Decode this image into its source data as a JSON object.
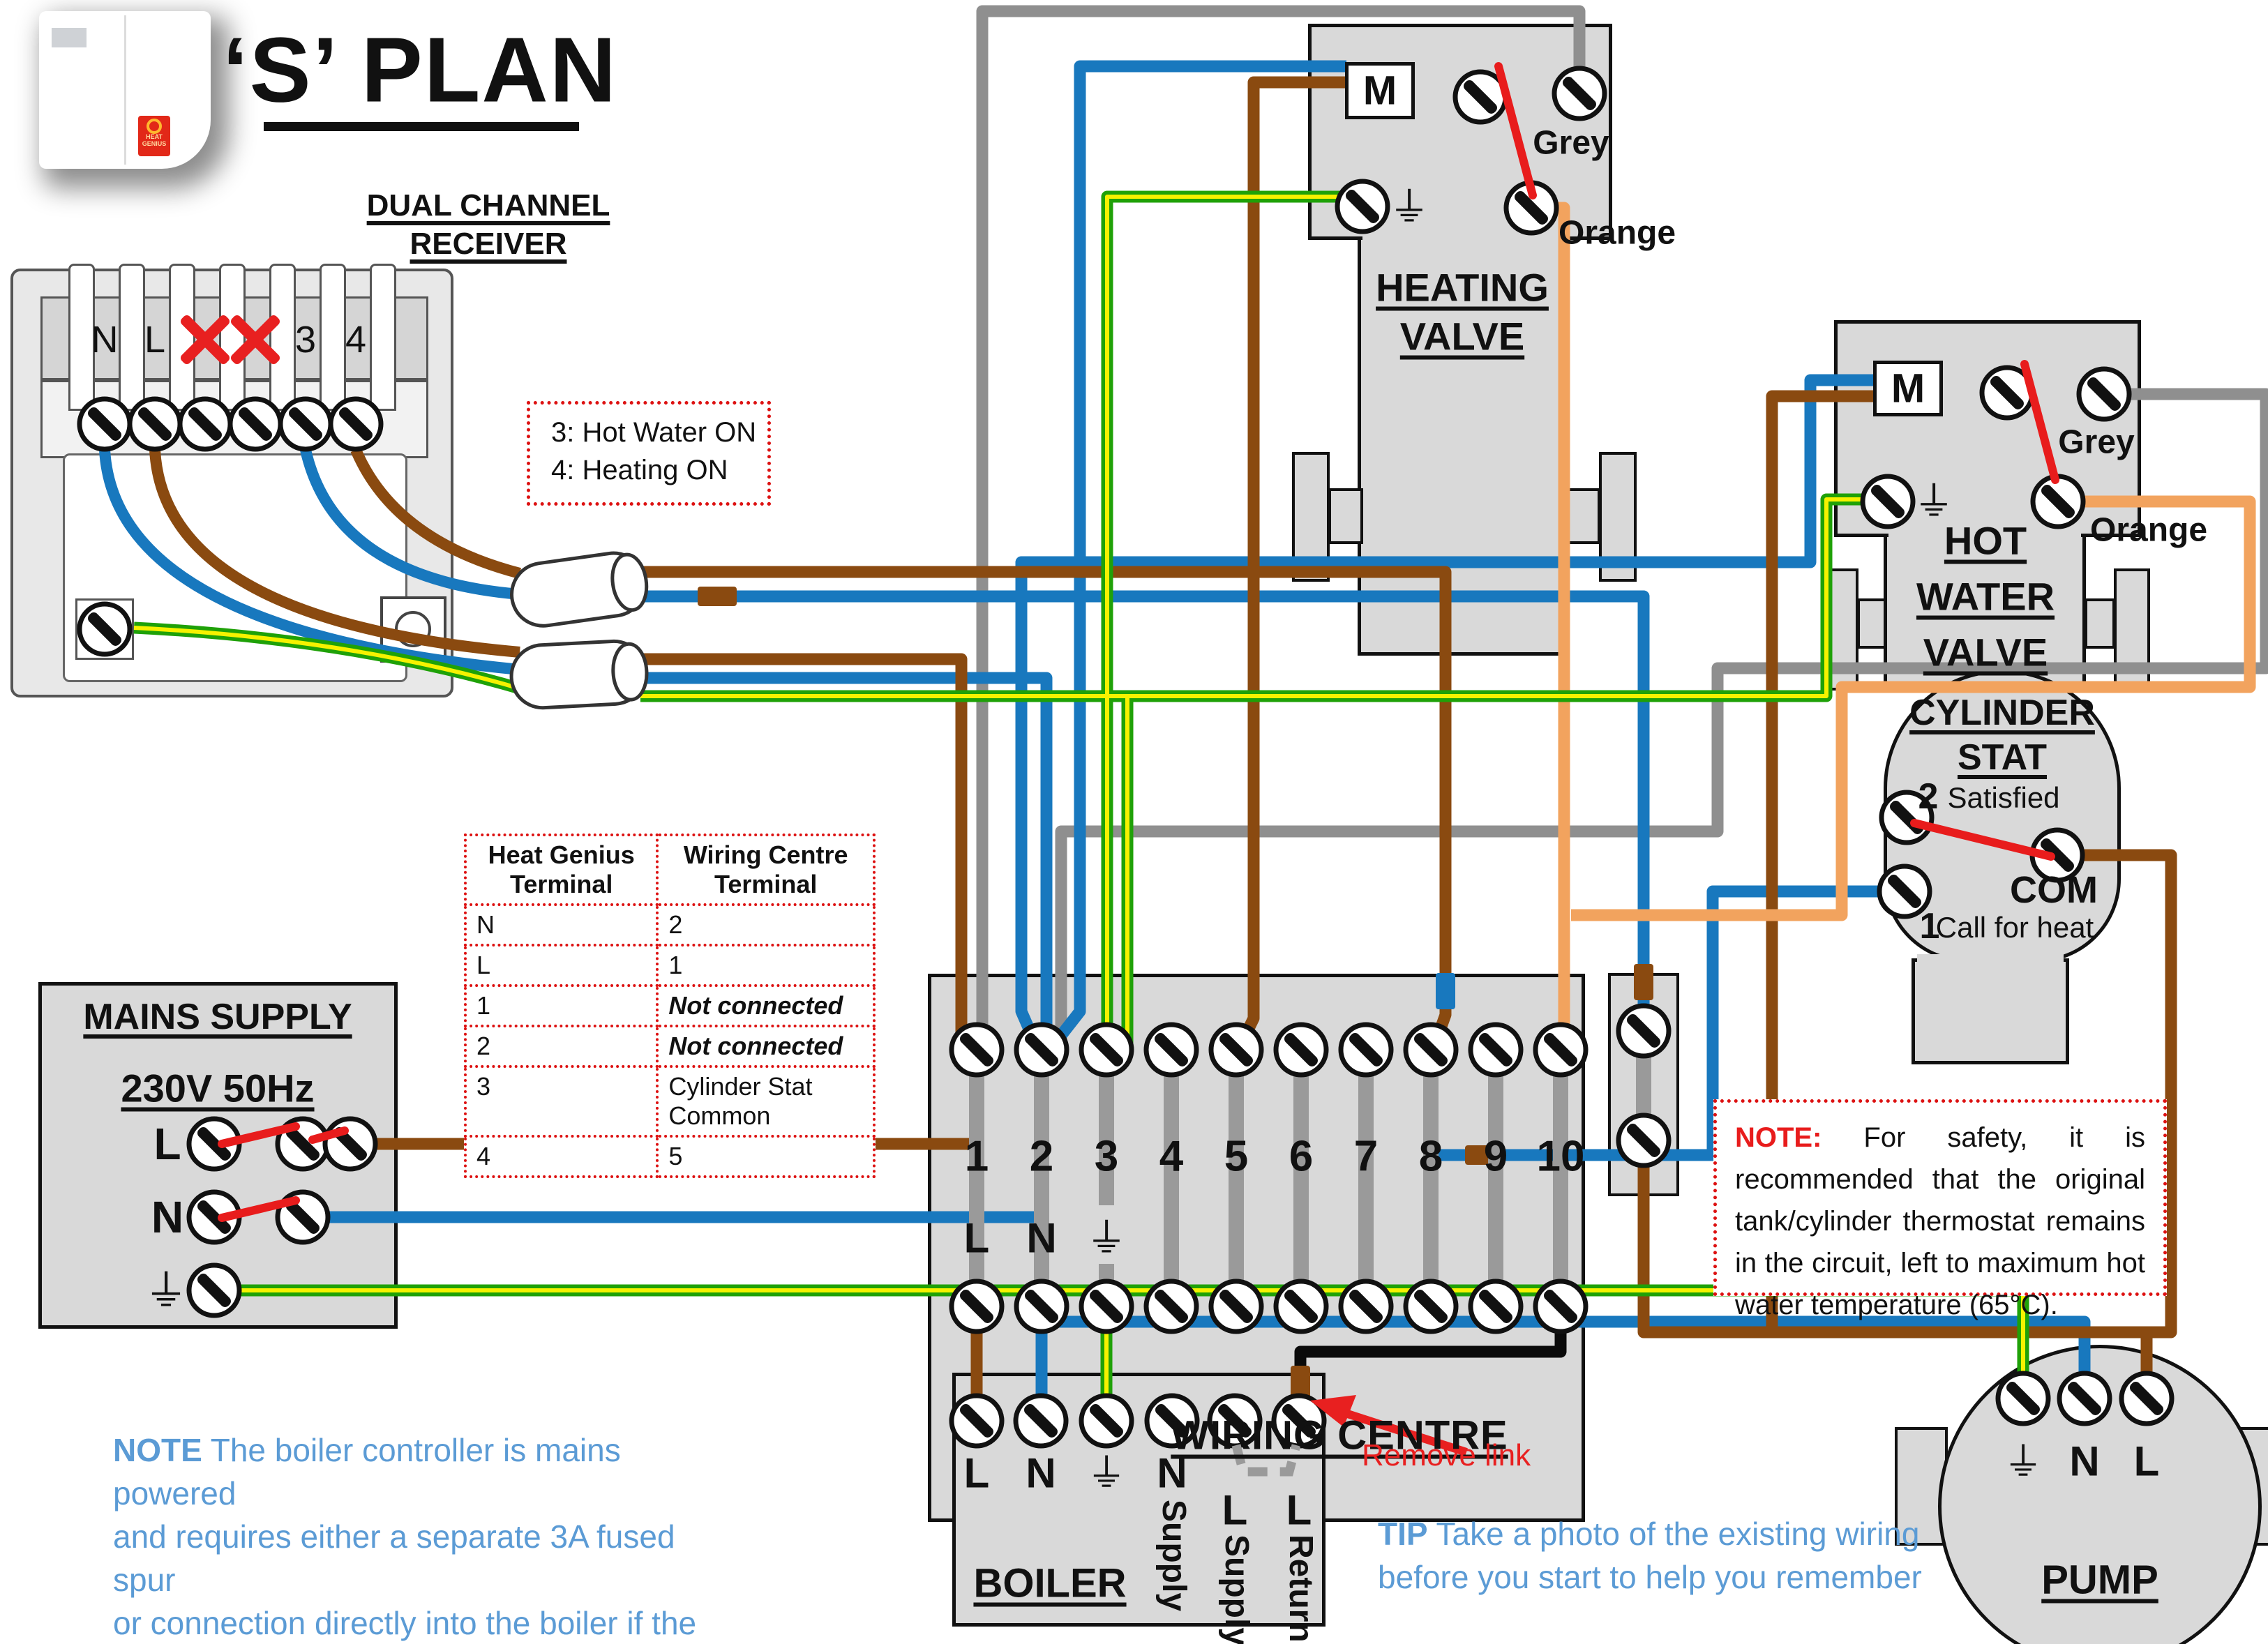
{
  "title": "‘S’ PLAN",
  "receiver": {
    "heading1": "DUAL CHANNEL",
    "heading2": "RECEIVER",
    "terminals": [
      "N",
      "L",
      "1",
      "2",
      "3",
      "4"
    ],
    "crossed_terminals": [
      "1",
      "2"
    ]
  },
  "channel_note": {
    "line1": "3: Hot Water ON",
    "line2": "4: Heating ON"
  },
  "table": {
    "col1_header": "Heat Genius\nTerminal",
    "col2_header": "Wiring Centre\nTerminal",
    "rows": [
      [
        "N",
        "2"
      ],
      [
        "L",
        "1"
      ],
      [
        "1",
        "Not connected"
      ],
      [
        "2",
        "Not connected"
      ],
      [
        "3",
        "Cylinder Stat Common"
      ],
      [
        "4",
        "5"
      ]
    ]
  },
  "mains": {
    "title": "MAINS SUPPLY",
    "subtitle": "230V 50Hz",
    "l": "L",
    "n": "N",
    "earth": "⏚"
  },
  "wiring_centre": {
    "label": "WIRING CENTRE",
    "numbers": [
      "1",
      "2",
      "3",
      "4",
      "5",
      "6",
      "7",
      "8",
      "9",
      "10"
    ],
    "l": "L",
    "n": "N",
    "earth": "⏚"
  },
  "heating_valve": {
    "m": "M",
    "grey": "Grey",
    "orange": "Orange",
    "name1": "HEATING",
    "name2": "VALVE"
  },
  "hot_water_valve": {
    "m": "M",
    "grey": "Grey",
    "orange": "Orange",
    "name1": "HOT",
    "name2": "WATER",
    "name3": "VALVE"
  },
  "cylinder_stat": {
    "title1": "CYLINDER",
    "title2": "STAT",
    "satisfied_num": "2",
    "satisfied": "Satisfied",
    "com": "COM",
    "call_num": "1",
    "call": "Call for heat"
  },
  "boiler": {
    "label": "BOILER",
    "l": "L",
    "n": "N",
    "earth": "⏚",
    "t4_h": "N",
    "t4_v": "Supply",
    "t5_h": "L",
    "t5_v": "Supply",
    "t6_h": "L",
    "t6_v": "Return"
  },
  "pump": {
    "label": "PUMP",
    "earth": "⏚",
    "n": "N",
    "l": "L"
  },
  "remove_link": "Remove link",
  "tip": {
    "prefix": "TIP",
    "line1": " Take a photo of the existing wiring",
    "line2": "before you start to help you remember"
  },
  "boiler_note": {
    "prefix": "NOTE",
    "line1": " The boiler controller is mains powered",
    "line2": "and requires either a separate 3A fused spur",
    "line3": "or connection directly into the boiler if the",
    "line4": "boiler is powered from a 3A fused spur."
  },
  "safety_note": {
    "prefix": "NOTE:",
    "body": " For safety, it is recommended that the original tank/cylinder thermostat remains in the circuit, left to maximum hot water temperature (65°C)."
  },
  "logo": {
    "brand1": "HEAT",
    "brand2": "GENIUS"
  },
  "colors": {
    "wire_grey": "#8f8f8f",
    "wire_blue": "#1878be",
    "wire_brown": "#8a4a10",
    "wire_green": "#1fa108",
    "wire_yellow": "#f6f200",
    "wire_orange": "#f2a35e",
    "wire_black": "#0a0a0a",
    "switch_red": "#e81c1c",
    "component_grey": "#d9d9d9",
    "note_blue": "#5b9bd5",
    "dotted_red": "#dd1111"
  }
}
